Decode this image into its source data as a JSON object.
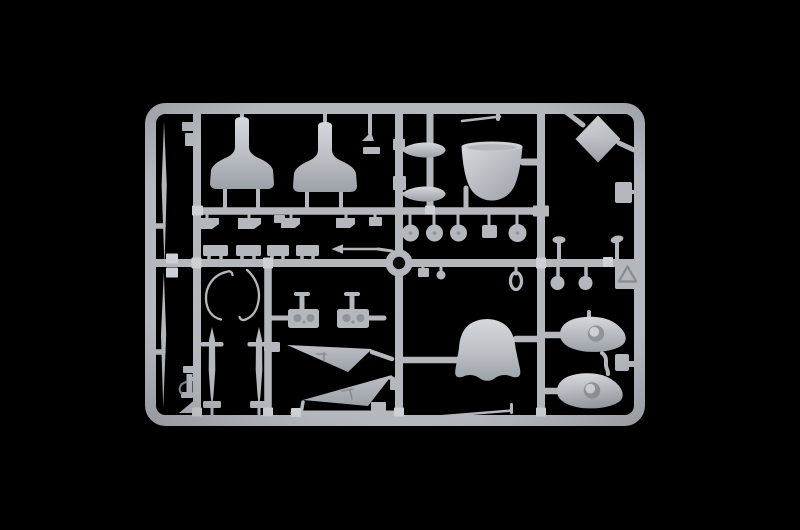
{
  "scene": {
    "description": "Studio photograph of an injection-molded plastic model kit sprue (light grey styrene runner with aircraft parts) centered on a pure black background",
    "background_color": "#000000"
  },
  "colors": {
    "background": "#000000",
    "plastic": "#b4b8bd",
    "plastic_light": "#cdd1d5",
    "plastic_dark": "#878c93",
    "recess": "#8f9499",
    "hole": "#0b0c0d",
    "grad_hi": "#d5d8db",
    "grad_mid": "#bcc0c5",
    "grad_lo": "#9ca1a8"
  },
  "sprue": {
    "frame": "rounded rectangular outer runner frame with internal vertical and horizontal runners",
    "parts": [
      {
        "name": "cowl-half-left",
        "description": "large bell-shaped fuselage cowl half, upper left"
      },
      {
        "name": "cowl-half-right",
        "description": "large bell-shaped fuselage cowl half, upper middle"
      },
      {
        "name": "nose-cone",
        "description": "bucket-shaped engine cowling, upper right of center"
      },
      {
        "name": "diamond-panel",
        "description": "flat square panel rotated 45 degrees, top right corner"
      },
      {
        "name": "drop-tank-upper",
        "description": "small elongated pod"
      },
      {
        "name": "drop-tank-lower",
        "description": "small elongated pod"
      },
      {
        "name": "dome-cowl",
        "description": "bell-shaped cowling with scalloped skirt, lower center"
      },
      {
        "name": "wheel-spat-upper",
        "description": "teardrop wheel spat with round boss, lower right"
      },
      {
        "name": "wheel-spat-lower",
        "description": "teardrop wheel spat with round boss, lower right"
      },
      {
        "name": "tail-fin-upper",
        "description": "thin triangular fin"
      },
      {
        "name": "tail-fin-lower",
        "description": "thin triangular fin"
      },
      {
        "name": "hole-plate-left",
        "description": "small plate with two round recesses"
      },
      {
        "name": "hole-plate-right",
        "description": "small plate with two round recesses"
      },
      {
        "name": "mast-left",
        "description": "tapered mast with crossbar"
      },
      {
        "name": "mast-right",
        "description": "tapered mast with crossbar"
      },
      {
        "name": "canopy-wire-left",
        "description": "thin curved frame part"
      },
      {
        "name": "canopy-wire-right",
        "description": "thin curved frame part"
      },
      {
        "name": "pitot-blade-upper",
        "description": "long thin blade in left margin"
      },
      {
        "name": "pitot-blade-lower",
        "description": "long thin blade in left margin"
      },
      {
        "name": "wheels",
        "description": "row of small round wheels on stems"
      },
      {
        "name": "gate-ring",
        "description": "circular ring boss at runner crossing"
      },
      {
        "name": "maker-tag",
        "description": "small molded tag with embossed triangle symbol"
      },
      {
        "name": "small-fittings",
        "description": "numerous small brackets, rods, balls and pads along the runners"
      }
    ]
  }
}
